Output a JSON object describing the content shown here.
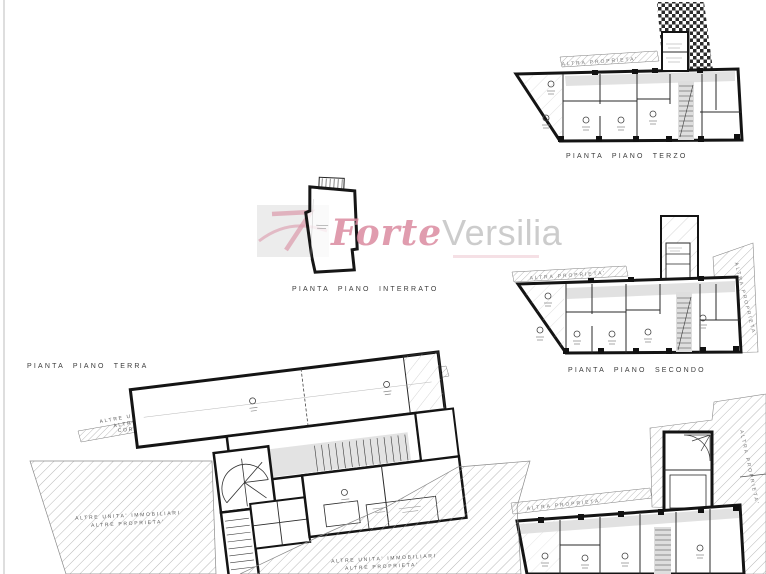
{
  "sheet": {
    "background": "#ffffff",
    "border_color": "#c9c9c9"
  },
  "titles": {
    "terzo": "PIANTA  PIANO  TERZO",
    "secondo": "PIANTA  PIANO  SECONDO",
    "interrato": "PIANTA  PIANO  INTERRATO",
    "terra": "PIANTA  PIANO  TERRA"
  },
  "annotations": {
    "altra_proprieta": "ALTRA PROPRIETA'",
    "altre_unita_immobiliari": "ALTRE UNITA' IMMOBILIARI",
    "altre_proprieta": "ALTRE PROPRIETA'",
    "corte_interna": "CORTE INTERNA"
  },
  "watermark": {
    "forte": "Forte",
    "versilia": "Versilia",
    "forte_color": "#db8ba0",
    "versilia_color": "#c4c4c4",
    "logo_bg": "#ececec",
    "logo_color": "#dc9aab"
  },
  "colors": {
    "wall": "#161616",
    "hatch_line": "#999999",
    "corridor_fill": "#dedede",
    "checker": "#2b2b2b"
  }
}
